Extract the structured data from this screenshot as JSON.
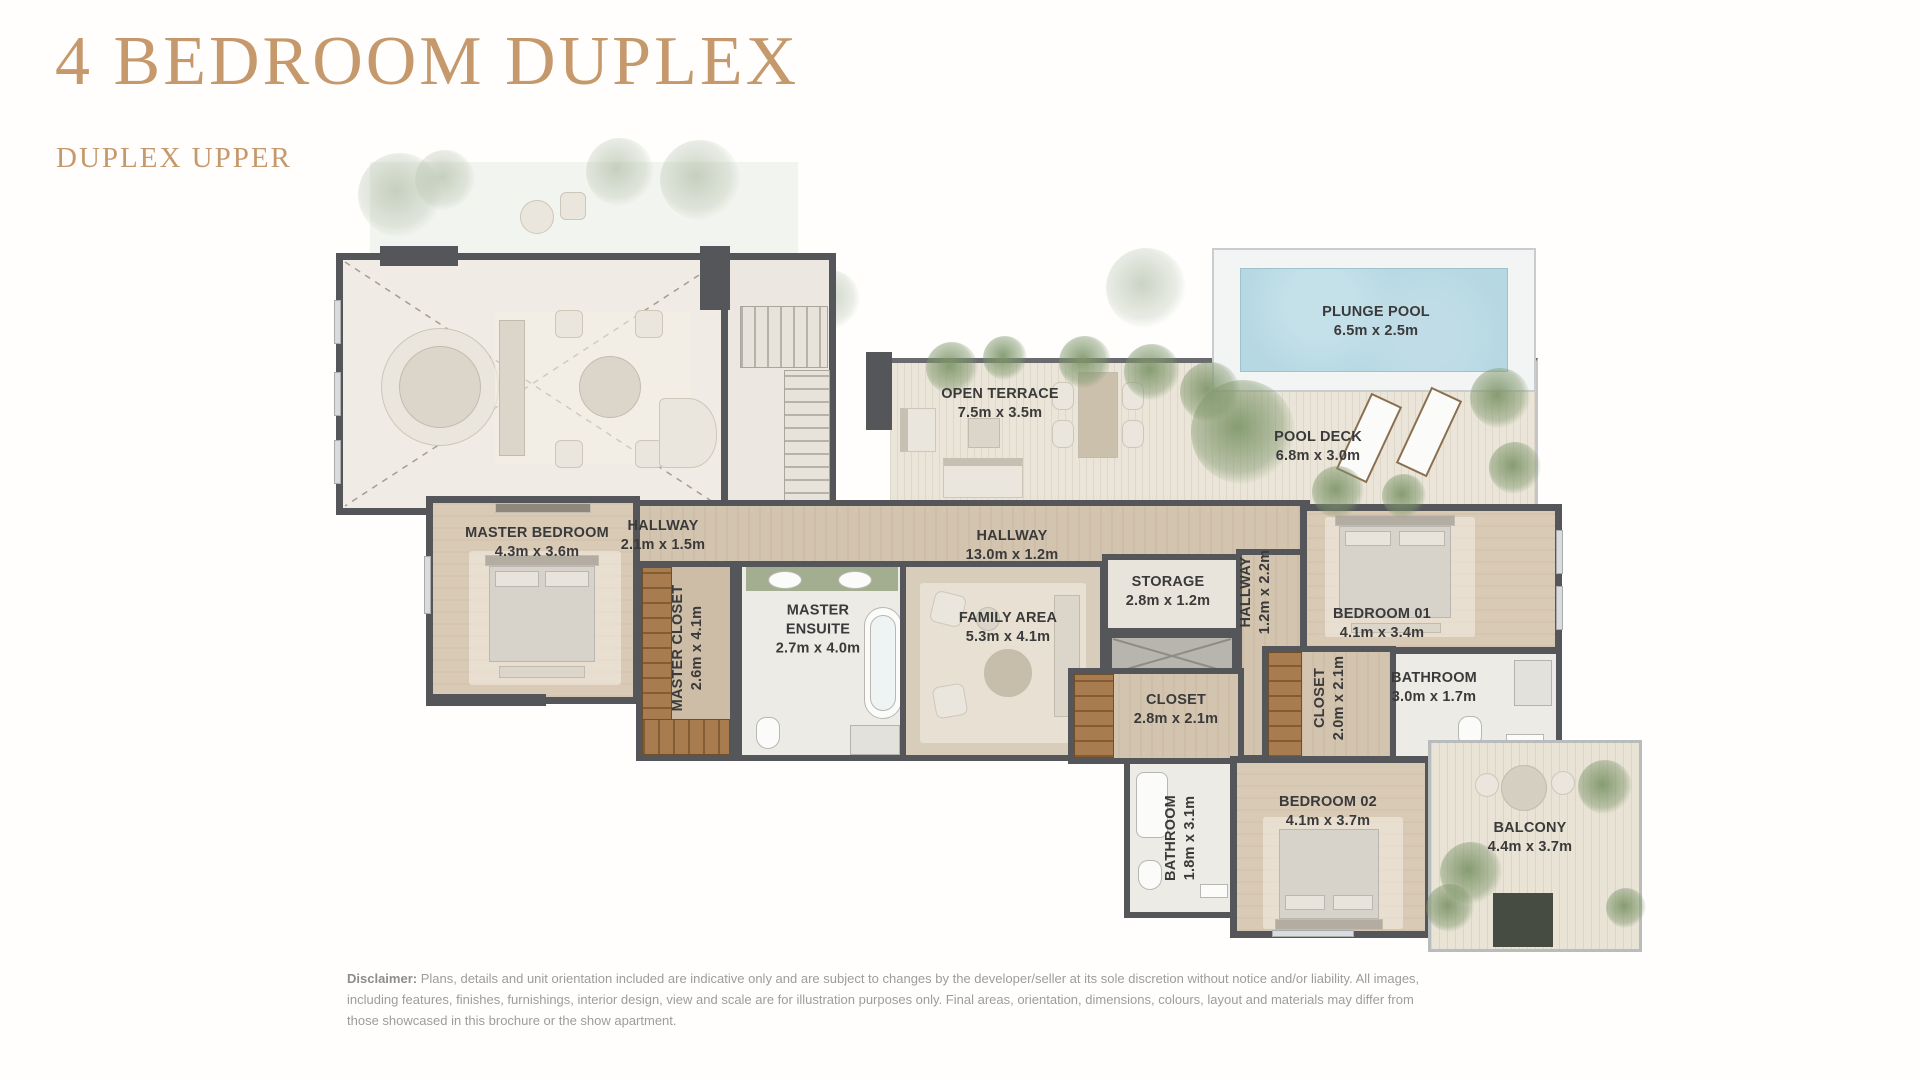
{
  "page": {
    "title": "4 BEDROOM DUPLEX",
    "subtitle": "DUPLEX UPPER"
  },
  "colors": {
    "accent_gold": "#C6996C",
    "wall": "#55565A",
    "wood_floor": "#D3C4AF",
    "bedroom_floor": "#D9CAB6",
    "tile_floor": "#EDEBE5",
    "deck_floor": "#E9E3D6",
    "closet_wood": "#A87C4E",
    "pool_water": "#B6D8E2",
    "foliage_green": "#7E966A",
    "label_text": "#3A3A3A"
  },
  "rooms": [
    {
      "id": "master_bedroom",
      "name": "MASTER BEDROOM",
      "dims": "4.3m x 3.6m"
    },
    {
      "id": "hallway_upper",
      "name": "HALLWAY",
      "dims": "2.1m x 1.5m"
    },
    {
      "id": "master_closet",
      "name": "MASTER CLOSET",
      "dims": "2.6m x 4.1m",
      "orientation": "vertical"
    },
    {
      "id": "master_ensuite",
      "name": "MASTER ENSUITE",
      "dims": "2.7m x 4.0m"
    },
    {
      "id": "hallway_main",
      "name": "HALLWAY",
      "dims": "13.0m x 1.2m"
    },
    {
      "id": "family_area",
      "name": "FAMILY AREA",
      "dims": "5.3m x 4.1m"
    },
    {
      "id": "storage",
      "name": "STORAGE",
      "dims": "2.8m x 1.2m"
    },
    {
      "id": "hallway_side",
      "name": "HALLWAY",
      "dims": "1.2m x 2.2m",
      "orientation": "vertical"
    },
    {
      "id": "bedroom_01",
      "name": "BEDROOM 01",
      "dims": "4.1m x 3.4m"
    },
    {
      "id": "bathroom_01",
      "name": "BATHROOM",
      "dims": "3.0m x 1.7m"
    },
    {
      "id": "closet_a",
      "name": "CLOSET",
      "dims": "2.8m x 2.1m"
    },
    {
      "id": "closet_b",
      "name": "CLOSET",
      "dims": "2.0m x 2.1m",
      "orientation": "vertical"
    },
    {
      "id": "bathroom_02",
      "name": "BATHROOM",
      "dims": "1.8m x 3.1m",
      "orientation": "vertical"
    },
    {
      "id": "bedroom_02",
      "name": "BEDROOM 02",
      "dims": "4.1m x 3.7m"
    },
    {
      "id": "balcony",
      "name": "BALCONY",
      "dims": "4.4m x 3.7m"
    },
    {
      "id": "open_terrace",
      "name": "OPEN TERRACE",
      "dims": "7.5m x 3.5m"
    },
    {
      "id": "pool_deck",
      "name": "POOL DECK",
      "dims": "6.8m x 3.0m"
    },
    {
      "id": "plunge_pool",
      "name": "PLUNGE POOL",
      "dims": "6.5m x 2.5m"
    }
  ],
  "disclaimer": {
    "label": "Disclaimer:",
    "text": "Plans, details and unit orientation included are indicative only and are subject to changes by the developer/seller at its sole discretion without notice and/or liability. All images, including features, finishes, furnishings, interior design, view and scale are for illustration purposes only. Final areas, orientation, dimensions, colours, layout and materials may differ from those showcased in this brochure or the show apartment."
  }
}
